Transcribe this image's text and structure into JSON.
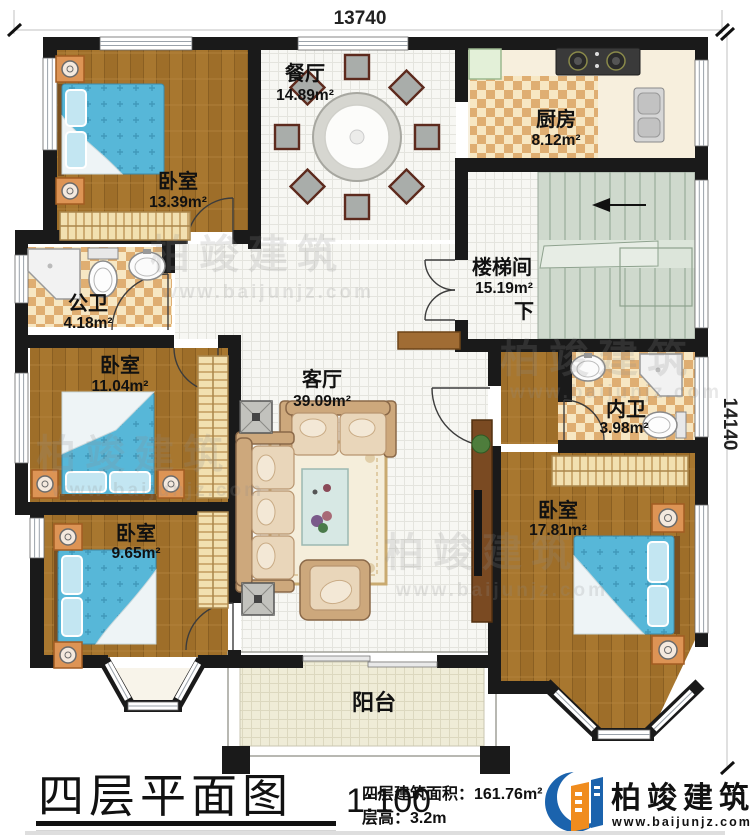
{
  "dimensions": {
    "top": "13740",
    "right": "14140"
  },
  "rooms": {
    "bedroom_tl": {
      "name": "卧室",
      "area": "13.39m²"
    },
    "dining": {
      "name": "餐厅",
      "area": "14.89m²"
    },
    "kitchen": {
      "name": "厨房",
      "area": "8.12m²"
    },
    "stairwell": {
      "name": "楼梯间",
      "area": "15.19m²",
      "down": "下"
    },
    "public_bath": {
      "name": "公卫",
      "area": "4.18m²"
    },
    "bedroom_ml": {
      "name": "卧室",
      "area": "11.04m²"
    },
    "living": {
      "name": "客厅",
      "area": "39.09m²"
    },
    "ensuite_bath": {
      "name": "内卫",
      "area": "3.98m²"
    },
    "bedroom_bl": {
      "name": "卧室",
      "area": "9.65m²"
    },
    "bedroom_br": {
      "name": "卧室",
      "area": "17.81m²"
    },
    "balcony": {
      "name": "阳台"
    }
  },
  "watermark": {
    "brand": "柏竣建筑",
    "url": "www.baijunjz.com"
  },
  "titleblock": {
    "title": "四层平面图",
    "scale": "1:100",
    "floor_area": "四层建筑面积：161.76m²",
    "floor_height": "层高：3.2m"
  },
  "logo": {
    "brand": "柏竣建筑",
    "url": "www.baijunjz.com"
  },
  "colors": {
    "wall": "#1a1a1a",
    "wood_floor": "#a8772f",
    "bed_blue": "#57b7d8",
    "bath_checker": "#dfae72",
    "stair_green": "#cfd9cd",
    "logo_blue": "#1b63ad",
    "logo_orange": "#f08c1e"
  }
}
